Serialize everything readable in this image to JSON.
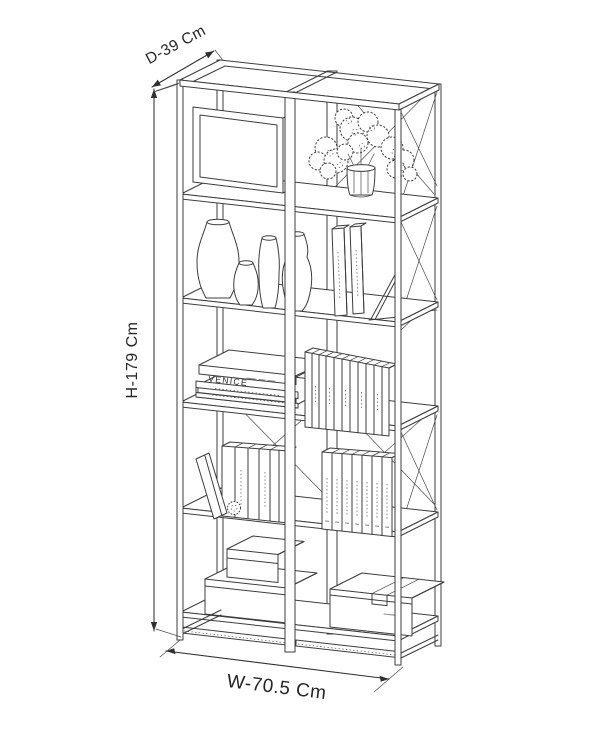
{
  "diagram": {
    "name": "bookshelf-dimension-diagram",
    "background_color": "#ffffff",
    "line_color": "#3d3d3d",
    "label_color": "#262626",
    "dimensions": {
      "depth": "D-39 Cm",
      "height": "H-179 Cm",
      "width": "W-70.5 Cm"
    },
    "decor_text": {
      "book_spine": "VENICE"
    },
    "depicted_objects": [
      "open-frame-bookshelf-2-columns-5-tiers",
      "framed-back-panel",
      "vase-with-hydrangea-flowers",
      "four-ceramic-vases",
      "standing-books-with-bookend",
      "stacked-flat-books-venice",
      "row-of-books",
      "leaning-book",
      "pinecone",
      "stacked-storage-boxes",
      "storage-box-with-strap"
    ]
  }
}
